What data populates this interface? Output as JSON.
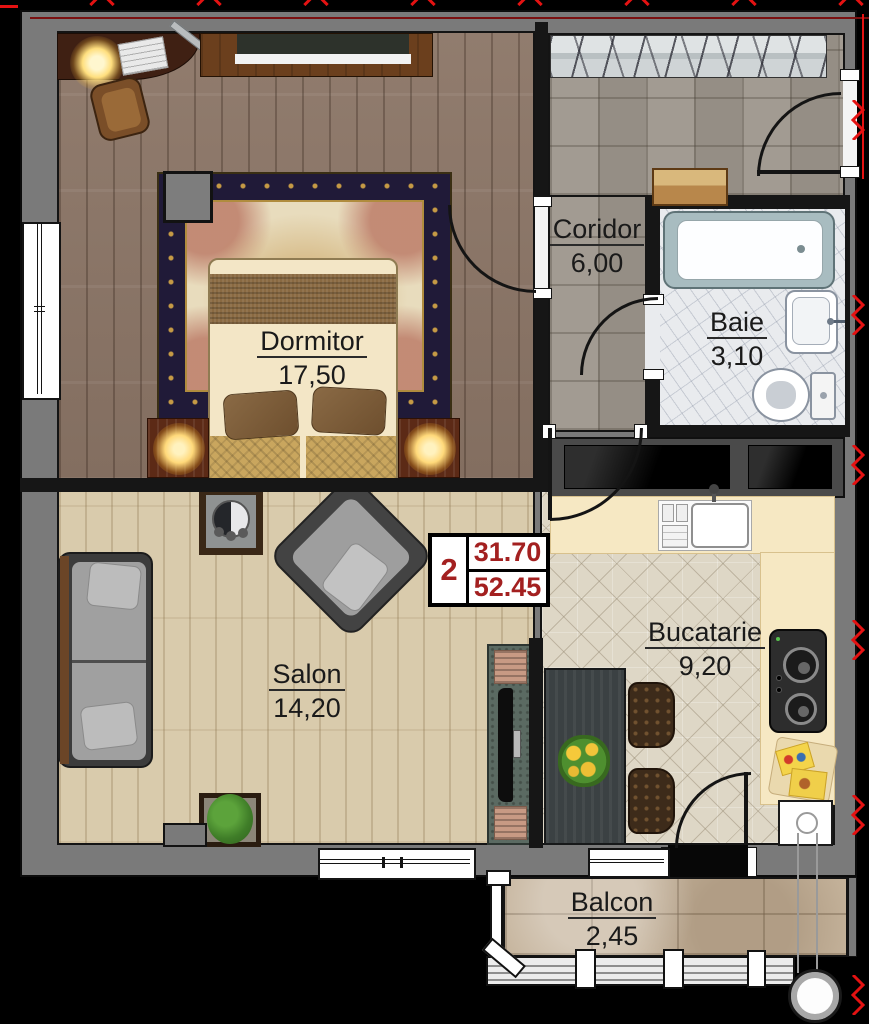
{
  "unit_box": {
    "number": "2",
    "area_top": "31.70",
    "area_bottom": "52.45"
  },
  "rooms": {
    "dormitor": {
      "name": "Dormitor",
      "area": "17,50"
    },
    "coridor": {
      "name": "Coridor",
      "area": "6,00"
    },
    "baie": {
      "name": "Baie",
      "area": "3,10"
    },
    "salon": {
      "name": "Salon",
      "area": "14,20"
    },
    "bucatarie": {
      "name": "Bucatarie",
      "area": "9,20"
    },
    "balcon": {
      "name": "Balcon",
      "area": "2,45"
    }
  },
  "colors": {
    "mark_red": "#e41212",
    "area_number_red": "#a32020",
    "wall_grey": "#7a7a7a"
  }
}
